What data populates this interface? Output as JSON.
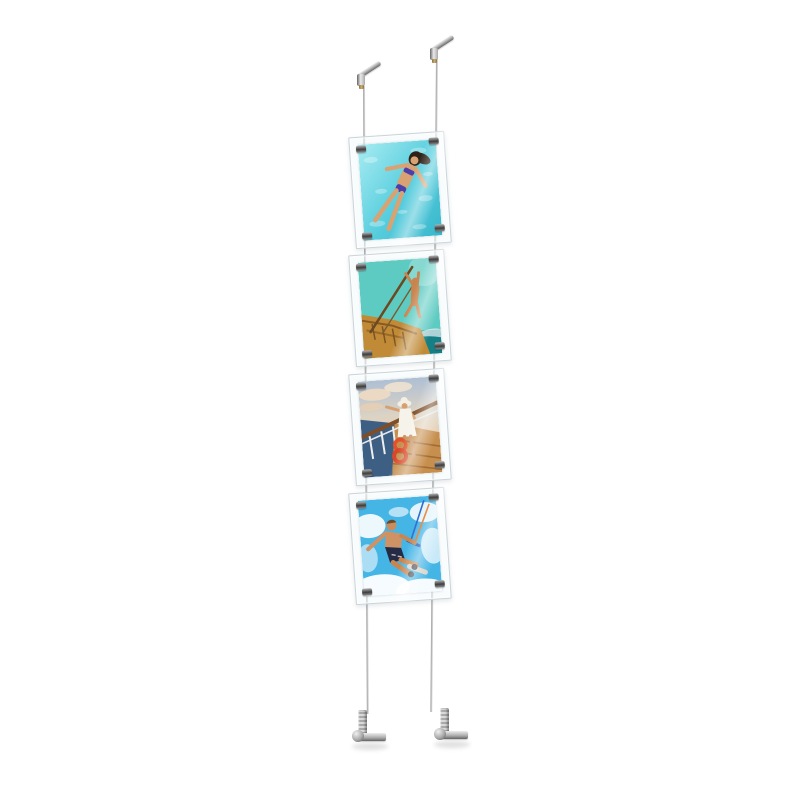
{
  "meta": {
    "description": "Product photo of a ceiling-to-floor tensioned cable display kit holding four vertical acrylic poster pockets with summer vacation photos",
    "background": "#ffffff",
    "poster_count": 4
  },
  "palette": {
    "bg": "#ffffff",
    "metal_mid": "#a9a9a9",
    "metal_dark": "#636363",
    "cable": "#c4c4c4",
    "acrylic_edge": "#c9d4d9",
    "brass": "#cfae72",
    "shadow": "rgba(0,0,0,0.12)"
  },
  "hardware": {
    "top_fixtures": [
      {
        "label": "ceiling cable anchor left"
      },
      {
        "label": "ceiling cable anchor right"
      }
    ],
    "bottom_fixtures": [
      {
        "label": "floor cable tensioner left"
      },
      {
        "label": "floor cable tensioner right"
      }
    ],
    "cables": [
      {
        "label": "left suspension cable"
      },
      {
        "label": "right suspension cable"
      }
    ],
    "grips_per_poster": 4
  },
  "posters": [
    {
      "id": 1,
      "description": "Woman in a purple bikini floating on her back in sparkling turquoise pool water",
      "dominant_color": "#56cddd"
    },
    {
      "id": 2,
      "description": "Tanned person diving from a wooden boat mast into the sea under a teal sky",
      "dominant_color": "#5ecbc2"
    },
    {
      "id": 3,
      "description": "Woman in a white dress and sun hat on a cruise ship deck with orange lifebuoys",
      "dominant_color": "#c9d5e0"
    },
    {
      "id": 4,
      "description": "Shirtless kitesurfer jumping through white sea spray against a blue sky",
      "dominant_color": "#45b5e6"
    }
  ]
}
